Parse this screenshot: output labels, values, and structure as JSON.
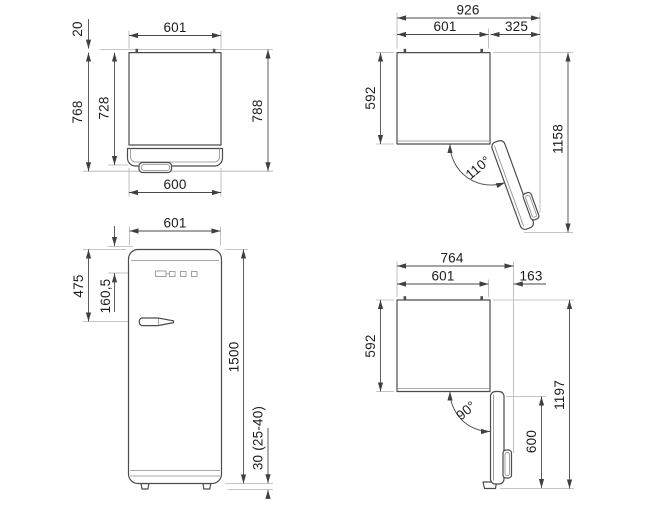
{
  "drawing": {
    "title": "refrigerator-installation-dimensions",
    "views": {
      "top_closed": {
        "label": "top-view-door-closed",
        "dims": {
          "width": "601",
          "rear_clearance": "20",
          "depth_with_door": "768",
          "depth_cabinet": "728",
          "depth_total": "788",
          "door_width": "600"
        }
      },
      "top_open_110": {
        "label": "top-view-door-open-110",
        "dims": {
          "total_width": "926",
          "cabinet_width": "601",
          "door_projection": "325",
          "cabinet_depth": "592",
          "total_depth": "1158",
          "door_angle": "110°"
        }
      },
      "front": {
        "label": "front-view",
        "dims": {
          "width": "601",
          "handle_from_top": "475",
          "logo_from_top": "160,5",
          "height": "1500",
          "feet_height": "30 (25-40)"
        }
      },
      "top_open_90": {
        "label": "top-view-door-open-90",
        "dims": {
          "total_width": "764",
          "cabinet_width": "601",
          "door_projection": "163",
          "cabinet_depth": "592",
          "door_depth": "600",
          "total_depth": "1197",
          "door_angle": "90°"
        }
      }
    }
  }
}
